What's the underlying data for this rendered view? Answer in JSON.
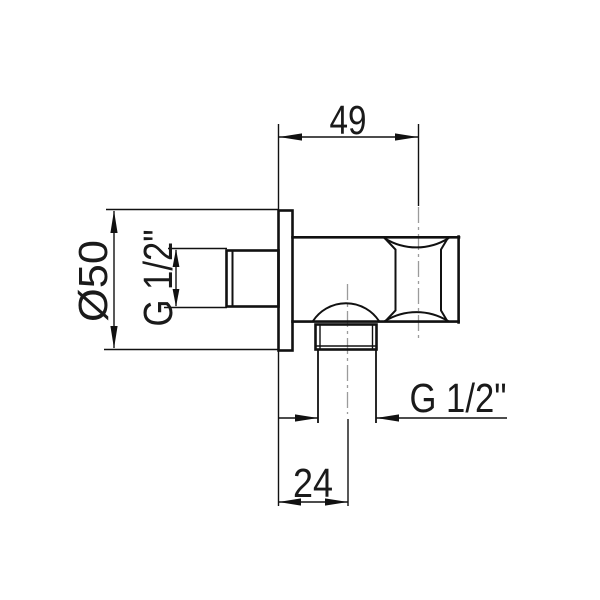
{
  "drawing": {
    "type": "technical-dimension-drawing",
    "subject": "shower-wall-outlet-elbow-side-view",
    "background_color": "#ffffff",
    "line_color": "#111111",
    "centerline_color": "#9b9b9b",
    "text_color": "#1a1a1a",
    "dimensions": {
      "top_width": "49",
      "plate_diameter": "Ø50",
      "inlet_thread": "G 1/2\"",
      "outlet_thread": "G 1/2\"",
      "outlet_offset": "24"
    }
  }
}
